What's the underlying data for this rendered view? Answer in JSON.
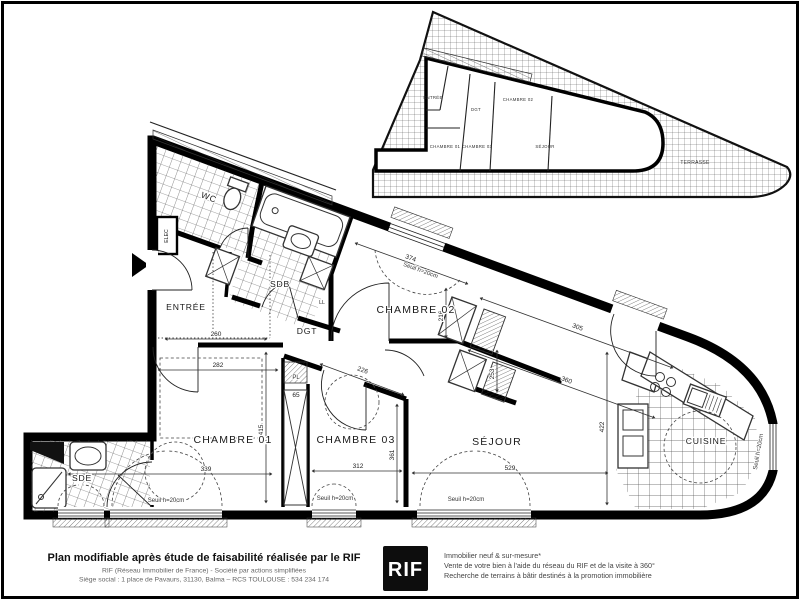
{
  "colors": {
    "ink": "#000000",
    "paper": "#ffffff",
    "muted": "#555555"
  },
  "plan": {
    "rooms": {
      "entree": "ENTRÉE",
      "wc": "WC",
      "sdb": "SDB",
      "dgt": "DGT",
      "ll": "LL",
      "elec": "ELEC",
      "pl": "PL",
      "chambre01": "CHAMBRE 01",
      "chambre02": "CHAMBRE 02",
      "chambre03": "CHAMBRE 03",
      "sejour": "SÉJOUR",
      "cuisine": "CUISINE",
      "sde": "SDE"
    },
    "dimensions": {
      "entree_w": "260",
      "ch01_w": "282",
      "ch01_h": "415",
      "left_chain": "339",
      "pl_w": "65",
      "ch03_w": "312",
      "ch03_h": "361",
      "ch03_diag": "226",
      "ch02_w": "374",
      "ch02_h": "216",
      "closet_h": "253",
      "sejour_diag_upper": "305",
      "sejour_diag_lower": "360",
      "sejour_h": "422",
      "sejour_w": "529"
    },
    "window_sill_label": "Seuil h=20cm",
    "inset": {
      "terrasse": "TERRASSE",
      "entree": "ENTRÉE",
      "dgt": "DGT",
      "chambre01": "CHAMBRE 01",
      "chambre02": "CHAMBRE 02",
      "chambre03": "CHAMBRE 03",
      "sejour": "SÉJOUR"
    }
  },
  "footer": {
    "headline": "Plan modifiable après étude de faisabilité réalisée par le RIF",
    "company_line": "RIF (Réseau Immobilier de France)  -  Société par actions simplifiées",
    "address_line": "Siège social : 1 place de Pavaurs, 31130, Balma – RCS TOULOUSE : 534 234 174",
    "logo_text": "RIF",
    "services": {
      "line1": "Immobilier neuf & sur-mesure*",
      "line2": "Vente de votre bien à l'aide du réseau du RIF et de la visite à 360°",
      "line3": "Recherche de terrains à bâtir destinés à la promotion immobilière"
    }
  }
}
